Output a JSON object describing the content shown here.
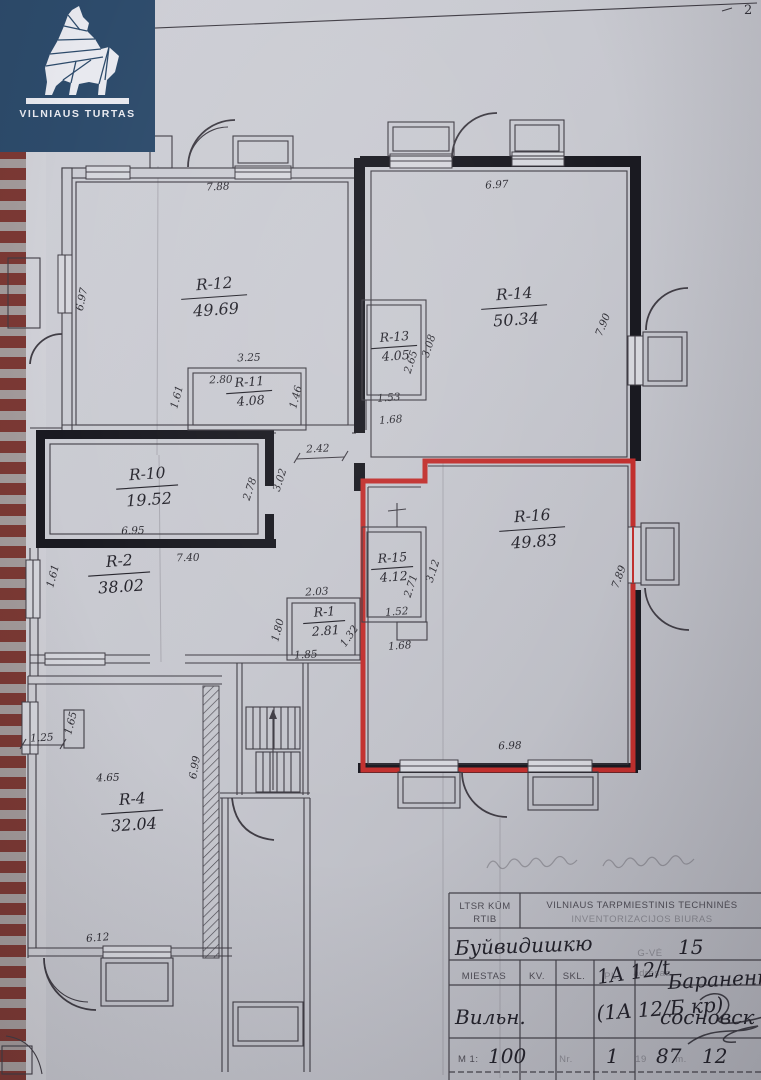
{
  "page": {
    "number": "2"
  },
  "logo": {
    "brand": "VILNIAUS TURTAS"
  },
  "rooms": {
    "r12": {
      "id": "R-12",
      "area": "49.69"
    },
    "r11": {
      "id": "R-11",
      "area": "4.08"
    },
    "r14": {
      "id": "R-14",
      "area": "50.34"
    },
    "r13": {
      "id": "R-13",
      "area": "4.05"
    },
    "r10": {
      "id": "R-10",
      "area": "19.52"
    },
    "r2": {
      "id": "R-2",
      "area": "38.02"
    },
    "r1": {
      "id": "R-1",
      "area": "2.81"
    },
    "r15": {
      "id": "R-15",
      "area": "4.12"
    },
    "r16": {
      "id": "R-16",
      "area": "49.83"
    },
    "r4": {
      "id": "R-4",
      "area": "32.04"
    }
  },
  "dims": {
    "r12_top": "7.88",
    "r12_left": "6.97",
    "r14_top": "6.97",
    "r14_right": "7.90",
    "r11_top": "3.25",
    "r11_width": "2.80",
    "r11_left": "1.61",
    "r11_right": "1.46",
    "r13_right": "3.08",
    "r13_inner": "2.65",
    "r13_w1": "1.53",
    "r13_w2": "1.68",
    "r10_opening": "2.42",
    "r10_right_a": "2.78",
    "r10_right_b": "3.02",
    "r10_bottom": "6.95",
    "r2_top": "7.40",
    "r2_left": "1.61",
    "r1_top": "2.03",
    "r1_left": "1.80",
    "r1_bottom": "1.85",
    "r1_diag": "1.32",
    "r15_right": "3.12",
    "r15_inner": "2.71",
    "r15_w1": "1.52",
    "r15_w2": "1.68",
    "r16_right": "7.89",
    "r16_bottom": "6.98",
    "r4_width": "4.65",
    "r4_closet": "1.65",
    "r4_left": "1.25",
    "r4_right": "6.99",
    "r4_bottom": "6.12"
  },
  "titleblock": {
    "agency_line1": "LTSR KŪM",
    "agency_line2": "RTIB",
    "bureau_line1": "VILNIAUS TARPMIESTINIS TECHNINĖS",
    "bureau_line2": "INVENTORIZACIJOS BIURAS",
    "street_name": "Буйвидишкю",
    "street_suffix": "G-VĖ",
    "street_number": "15",
    "col_city": "MIESTAS",
    "col_kv": "KV.",
    "col_skl": "SKL.",
    "col_pl": "PL.",
    "col_address": "adresas",
    "plot_code": "1A 12/t",
    "owner_name": "Бараненк",
    "city_value": "Вильн.",
    "building_code": "(1A 12/Б кр)",
    "surname2": "сосновск",
    "scale_label": "M 1:",
    "scale_value": "100",
    "doc_no_label": "Nr.",
    "doc_no": "1",
    "year_prefix": "19",
    "year": "87",
    "year_suffix": "m.",
    "month": "12"
  },
  "colors": {
    "accent_red": "#c2302e",
    "wall_black": "#1a1a21",
    "logo_navy": "#2d4b6b"
  }
}
